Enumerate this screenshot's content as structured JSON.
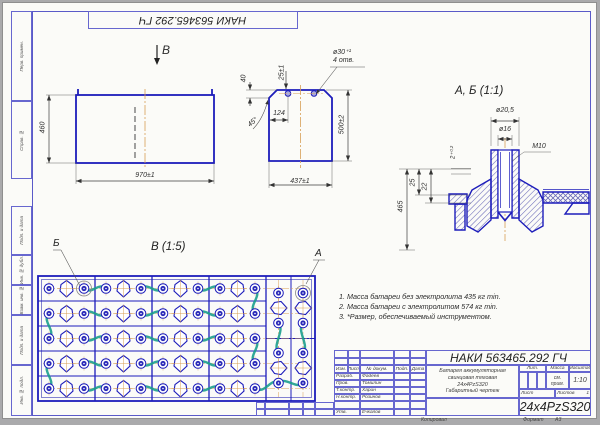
{
  "page": {
    "stamp_top": "НАКИ 563465.292 ГЧ"
  },
  "views": {
    "arrow_label": "В",
    "front": {
      "height": "460",
      "width": "970±1"
    },
    "side": {
      "chamfer_h": "40",
      "hole_offset": "25±1",
      "hole_dia": "ø30⁺¹",
      "hole_count": "4 отв.",
      "pitch": "124",
      "chamfer_angle": "45°",
      "height": "500±2",
      "width": "437±1"
    },
    "detail": {
      "title": "А, Б (1:1)",
      "d_outer": "ø20,5",
      "d_inner": "ø16",
      "thread": "М10",
      "lip": "2⁺⁰·²",
      "h25": "25",
      "h22": "22",
      "h465": "465"
    },
    "top": {
      "title": "В (1:5)",
      "label_a": "А",
      "label_b": "Б"
    }
  },
  "notes": [
    "1. Масса батареи без электролита 435 кг min.",
    "2. Масса батареи с электролитом 574 кг min.",
    "3. *Размер, обеспечиваемый инструментом."
  ],
  "title_block": {
    "designation": "НАКИ 563465.292 ГЧ",
    "header_cols": [
      "Изм.",
      "Лист",
      "№ докум.",
      "Подп.",
      "Дата"
    ],
    "rows": [
      [
        "Разраб.",
        "Фадеев"
      ],
      [
        "Пров.",
        "Томилин"
      ],
      [
        "Т.контр.",
        "Харин"
      ],
      [
        "Н.контр.",
        "Розинов"
      ],
      [
        "",
        ""
      ],
      [
        "Утв.",
        "Ечкалов"
      ]
    ],
    "description": [
      "Батарея аккумуляторная",
      "свинцовая тяговая",
      "24х4PzS320",
      "Габаритный чертеж"
    ],
    "lit_label": "Лит.",
    "mass_label": "Масса",
    "scale_label": "Масштаб",
    "mass_value": "см. прим.",
    "scale_value": "1:10",
    "sheet_label": "Лист",
    "sheets_label": "Листов",
    "sheets_value": "1",
    "part_code": "24x4PzS320",
    "copied_label": "Копировал",
    "format_label": "Формат",
    "format_value": "А3"
  },
  "frame_labels": [
    "Перв. примен.",
    "Справ. №",
    "Подп. и дата",
    "Инв. № дубл.",
    "Взам. инв. №",
    "Подп. и дата",
    "Инв. № подл."
  ]
}
